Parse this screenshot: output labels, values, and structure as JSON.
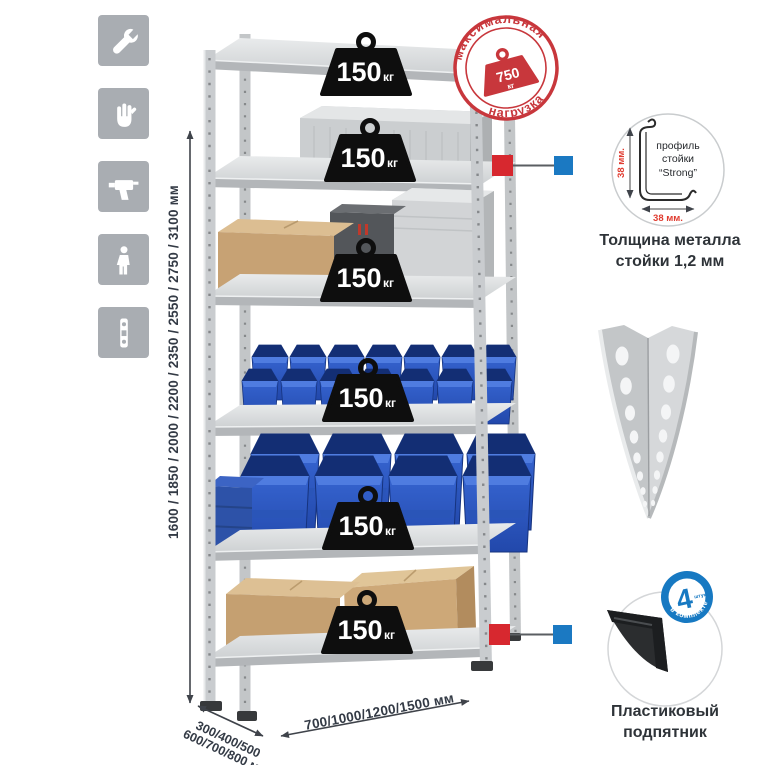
{
  "colors": {
    "accent_red": "#c8373c",
    "callout_red": "#d7282f",
    "accent_blue": "#1b79c2",
    "bin_blue": "#2e5ecb",
    "icon_bg": "#a9adb2",
    "metal_gray": "#c6c9cb",
    "weight_black": "#0e0e0e",
    "text_dark": "#2e3338"
  },
  "sidebar": {
    "icons": [
      {
        "name": "wrench"
      },
      {
        "name": "gloves"
      },
      {
        "name": "drill"
      },
      {
        "name": "person-height"
      },
      {
        "name": "level"
      }
    ]
  },
  "stamp": {
    "arc_top": "максимальная",
    "arc_bottom": "нагрузка",
    "value": "750",
    "unit": "кг"
  },
  "rack": {
    "shelf_count": 6,
    "load_value": "150",
    "load_unit": "кг"
  },
  "dimensions": {
    "height": "1600 / 1850 / 2000 / 2200 / 2350 / 2550 / 2750 / 3100 мм",
    "depth_line1": "300/400/500",
    "depth_line2": "600/700/800 мм",
    "width": "700/1000/1200/1500 мм"
  },
  "profile_detail": {
    "label_line1": "профиль",
    "label_line2": "стойки",
    "label_line3": "“Strong”",
    "dim_vertical": "38 мм.",
    "dim_horizontal": "38 мм.",
    "caption_line1": "Толщина металла",
    "caption_line2": "стойки 1,2 мм"
  },
  "foot_detail": {
    "badge_value": "4",
    "badge_small": "штуки",
    "badge_arc": "в комплекте",
    "caption_line1": "Пластиковый",
    "caption_line2": "подпятник"
  }
}
